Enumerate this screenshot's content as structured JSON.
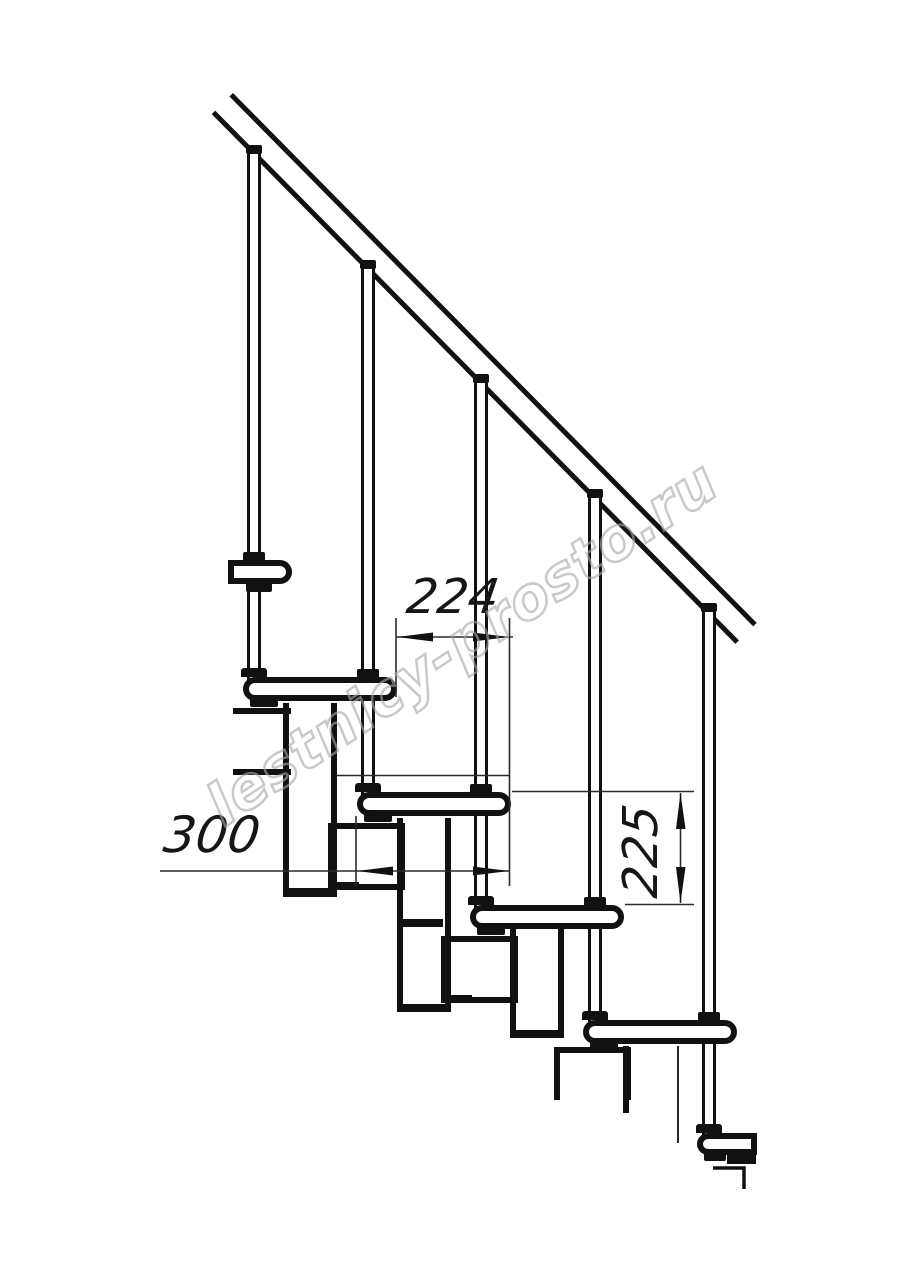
{
  "image": {
    "width": 914,
    "height": 1280,
    "background": "#ffffff",
    "line_color": "#111111",
    "dim_line_color": "#2a2a2a"
  },
  "drawing": {
    "subject": "modular-staircase-side-elevation",
    "steps_visible": 5,
    "balusters_visible": 5,
    "dimensions": [
      {
        "id": "tread-run",
        "label": "224",
        "orientation": "horizontal"
      },
      {
        "id": "tread-depth",
        "label": "300",
        "orientation": "horizontal"
      },
      {
        "id": "step-rise",
        "label": "225",
        "orientation": "vertical"
      }
    ],
    "watermark": {
      "text": "lestnicy-prosto.ru",
      "color": "#a8a8a8"
    }
  }
}
